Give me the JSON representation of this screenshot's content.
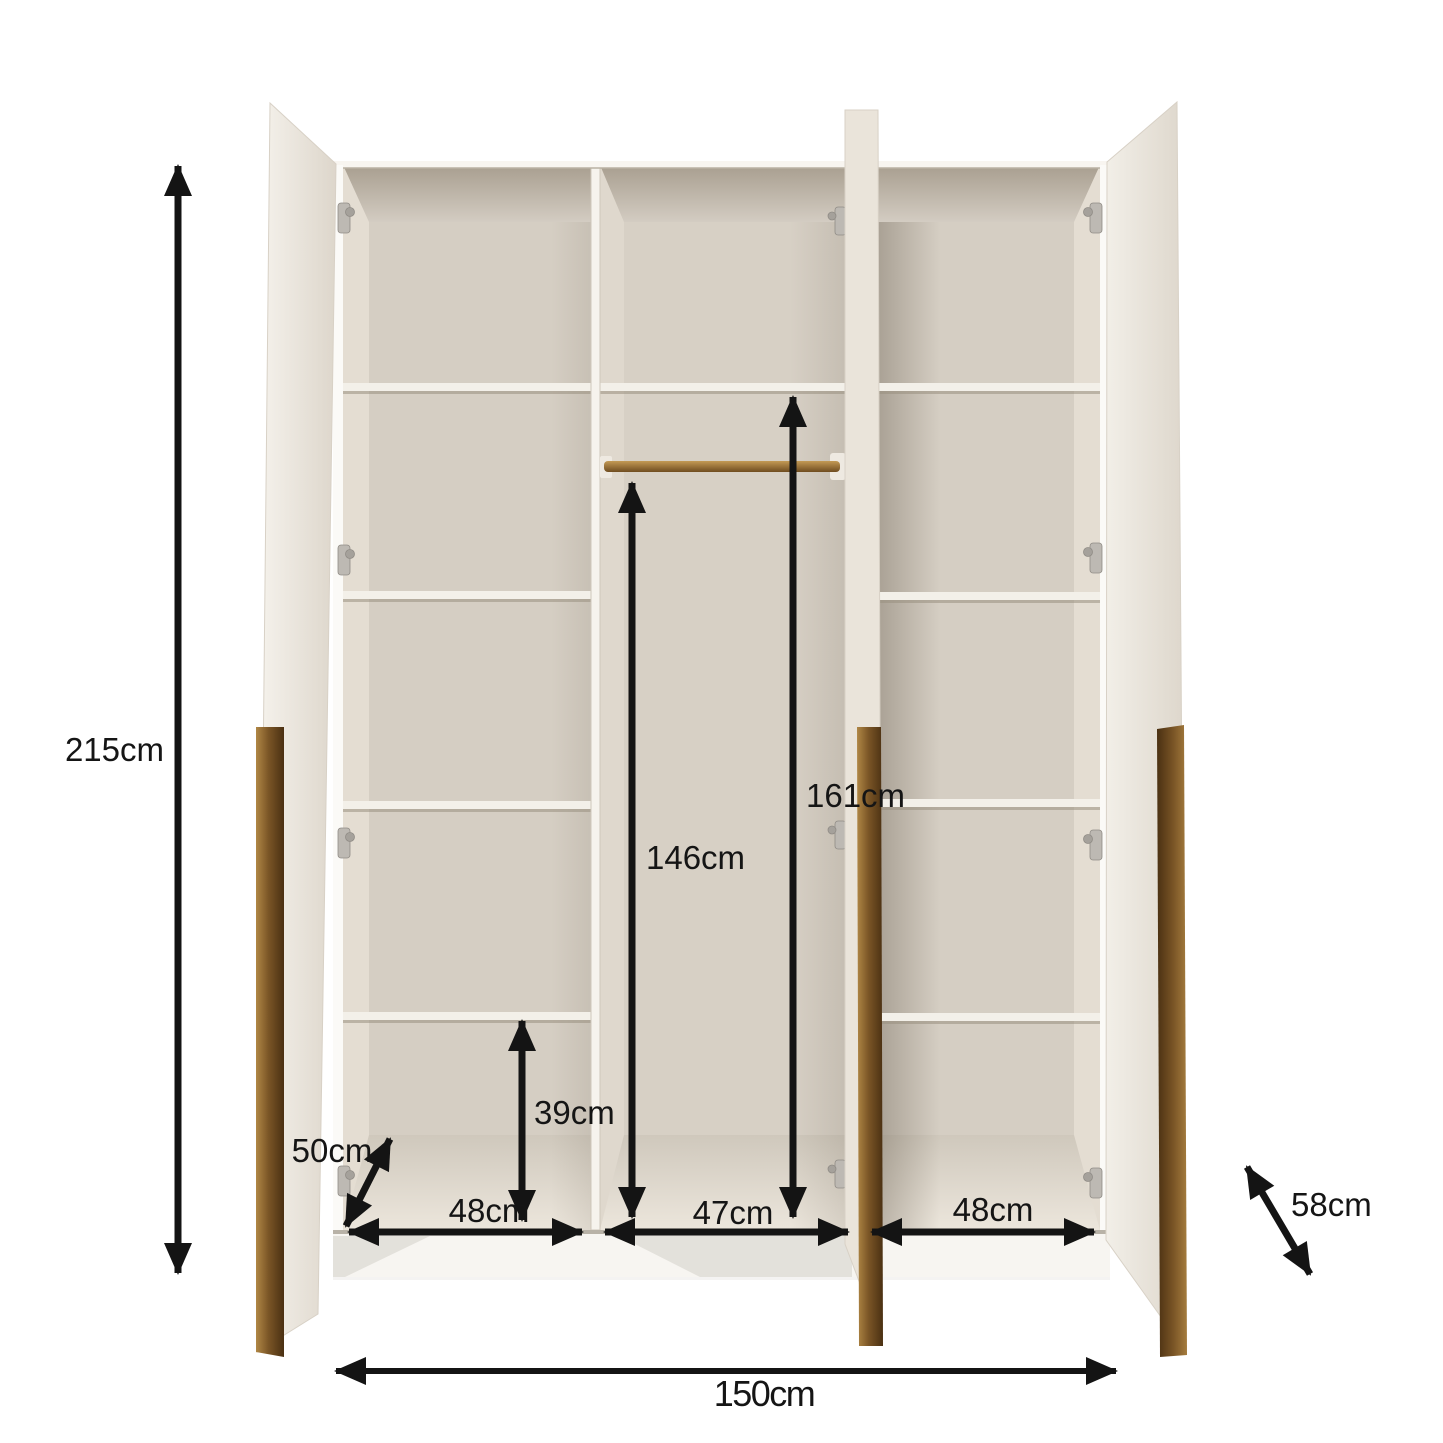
{
  "page": {
    "background": "#ffffff"
  },
  "diagram": {
    "type": "wardrobe-dimension-diagram",
    "subject": "3-door open wardrobe with shelves, hanging rail and gold handles",
    "labels": {
      "height": "215cm",
      "width": "150cm",
      "depth": "58cm",
      "door_width": "50cm",
      "left_section_width": "48cm",
      "middle_section_width": "47cm",
      "right_section_width": "48cm",
      "hanging_clearance": "146cm",
      "inner_height": "161cm",
      "bottom_compartment": "39cm"
    },
    "colors": {
      "background": "#ffffff",
      "arrow": "#141414",
      "gold_handle": "#7a5526",
      "interior_wall": "#d5cec3",
      "carcass": "#f7f4ee",
      "hinge": "#bdb9b3"
    }
  }
}
